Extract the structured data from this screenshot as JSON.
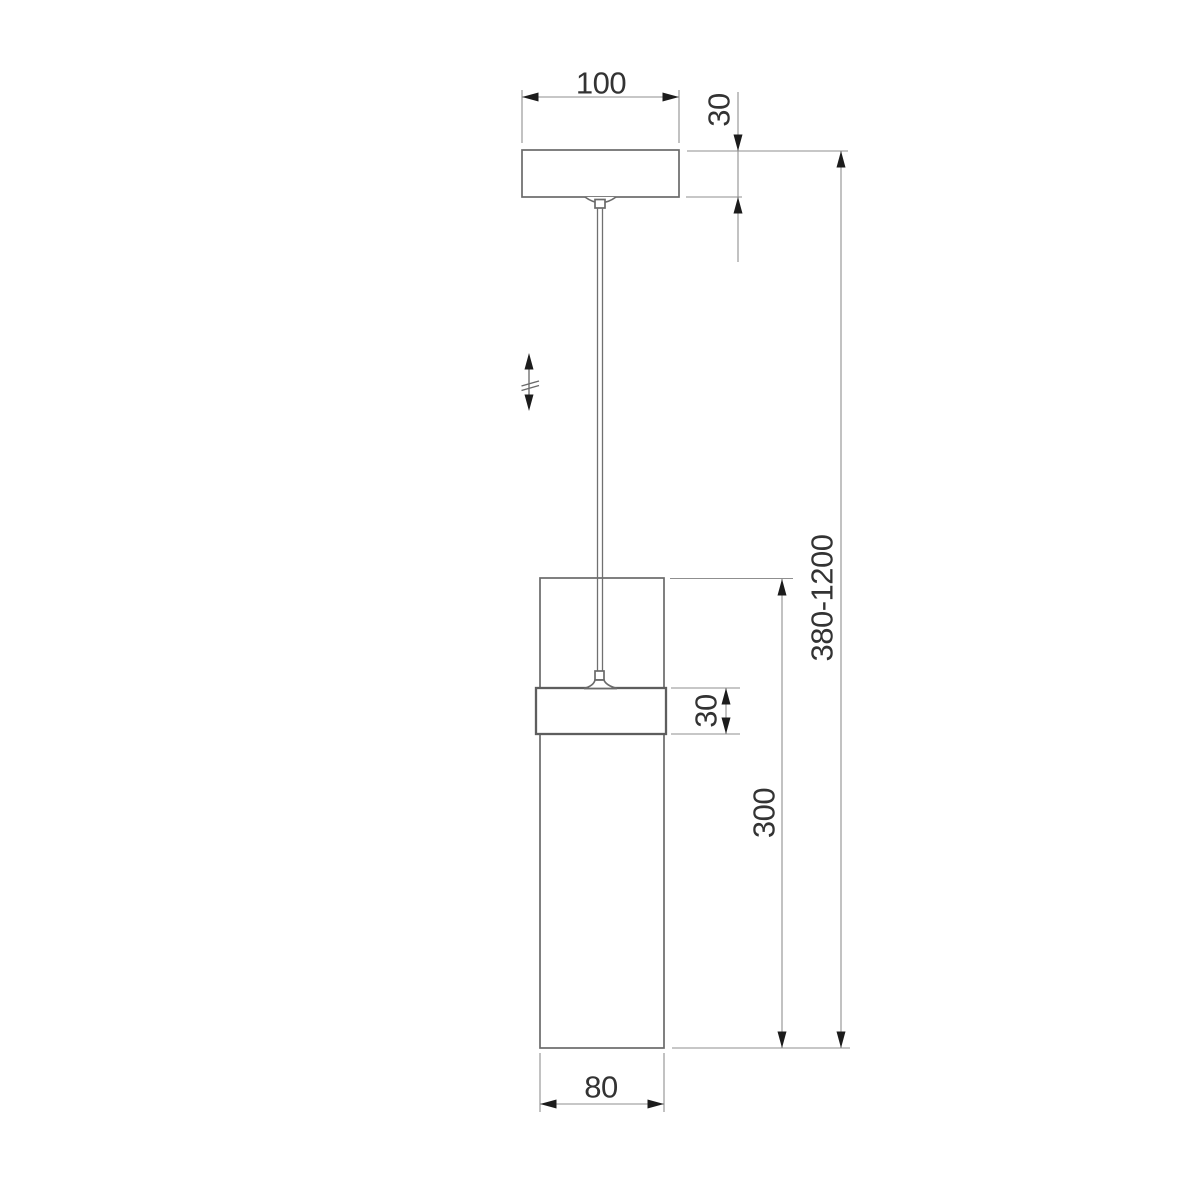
{
  "title": "Pendant lamp dimensional drawing",
  "colors": {
    "background": "#ffffff",
    "object_line": "#6a6a6a",
    "band_line": "#5e5e5e",
    "dimension_line": "#8f8f8f",
    "arrowhead": "#1c1c1c",
    "text": "#333333"
  },
  "labels": {
    "canopy_width": "100",
    "canopy_height": "30",
    "overall_height": "380-1200",
    "shade_height": "300",
    "band_height": "30",
    "shade_diameter": "80"
  },
  "parts": {
    "canopy": "ceiling canopy",
    "cord": "suspension cord",
    "shade": "cylindrical glass shade",
    "band": "metal band",
    "height_adjust_icon": "double-headed-arrow-with-break"
  }
}
